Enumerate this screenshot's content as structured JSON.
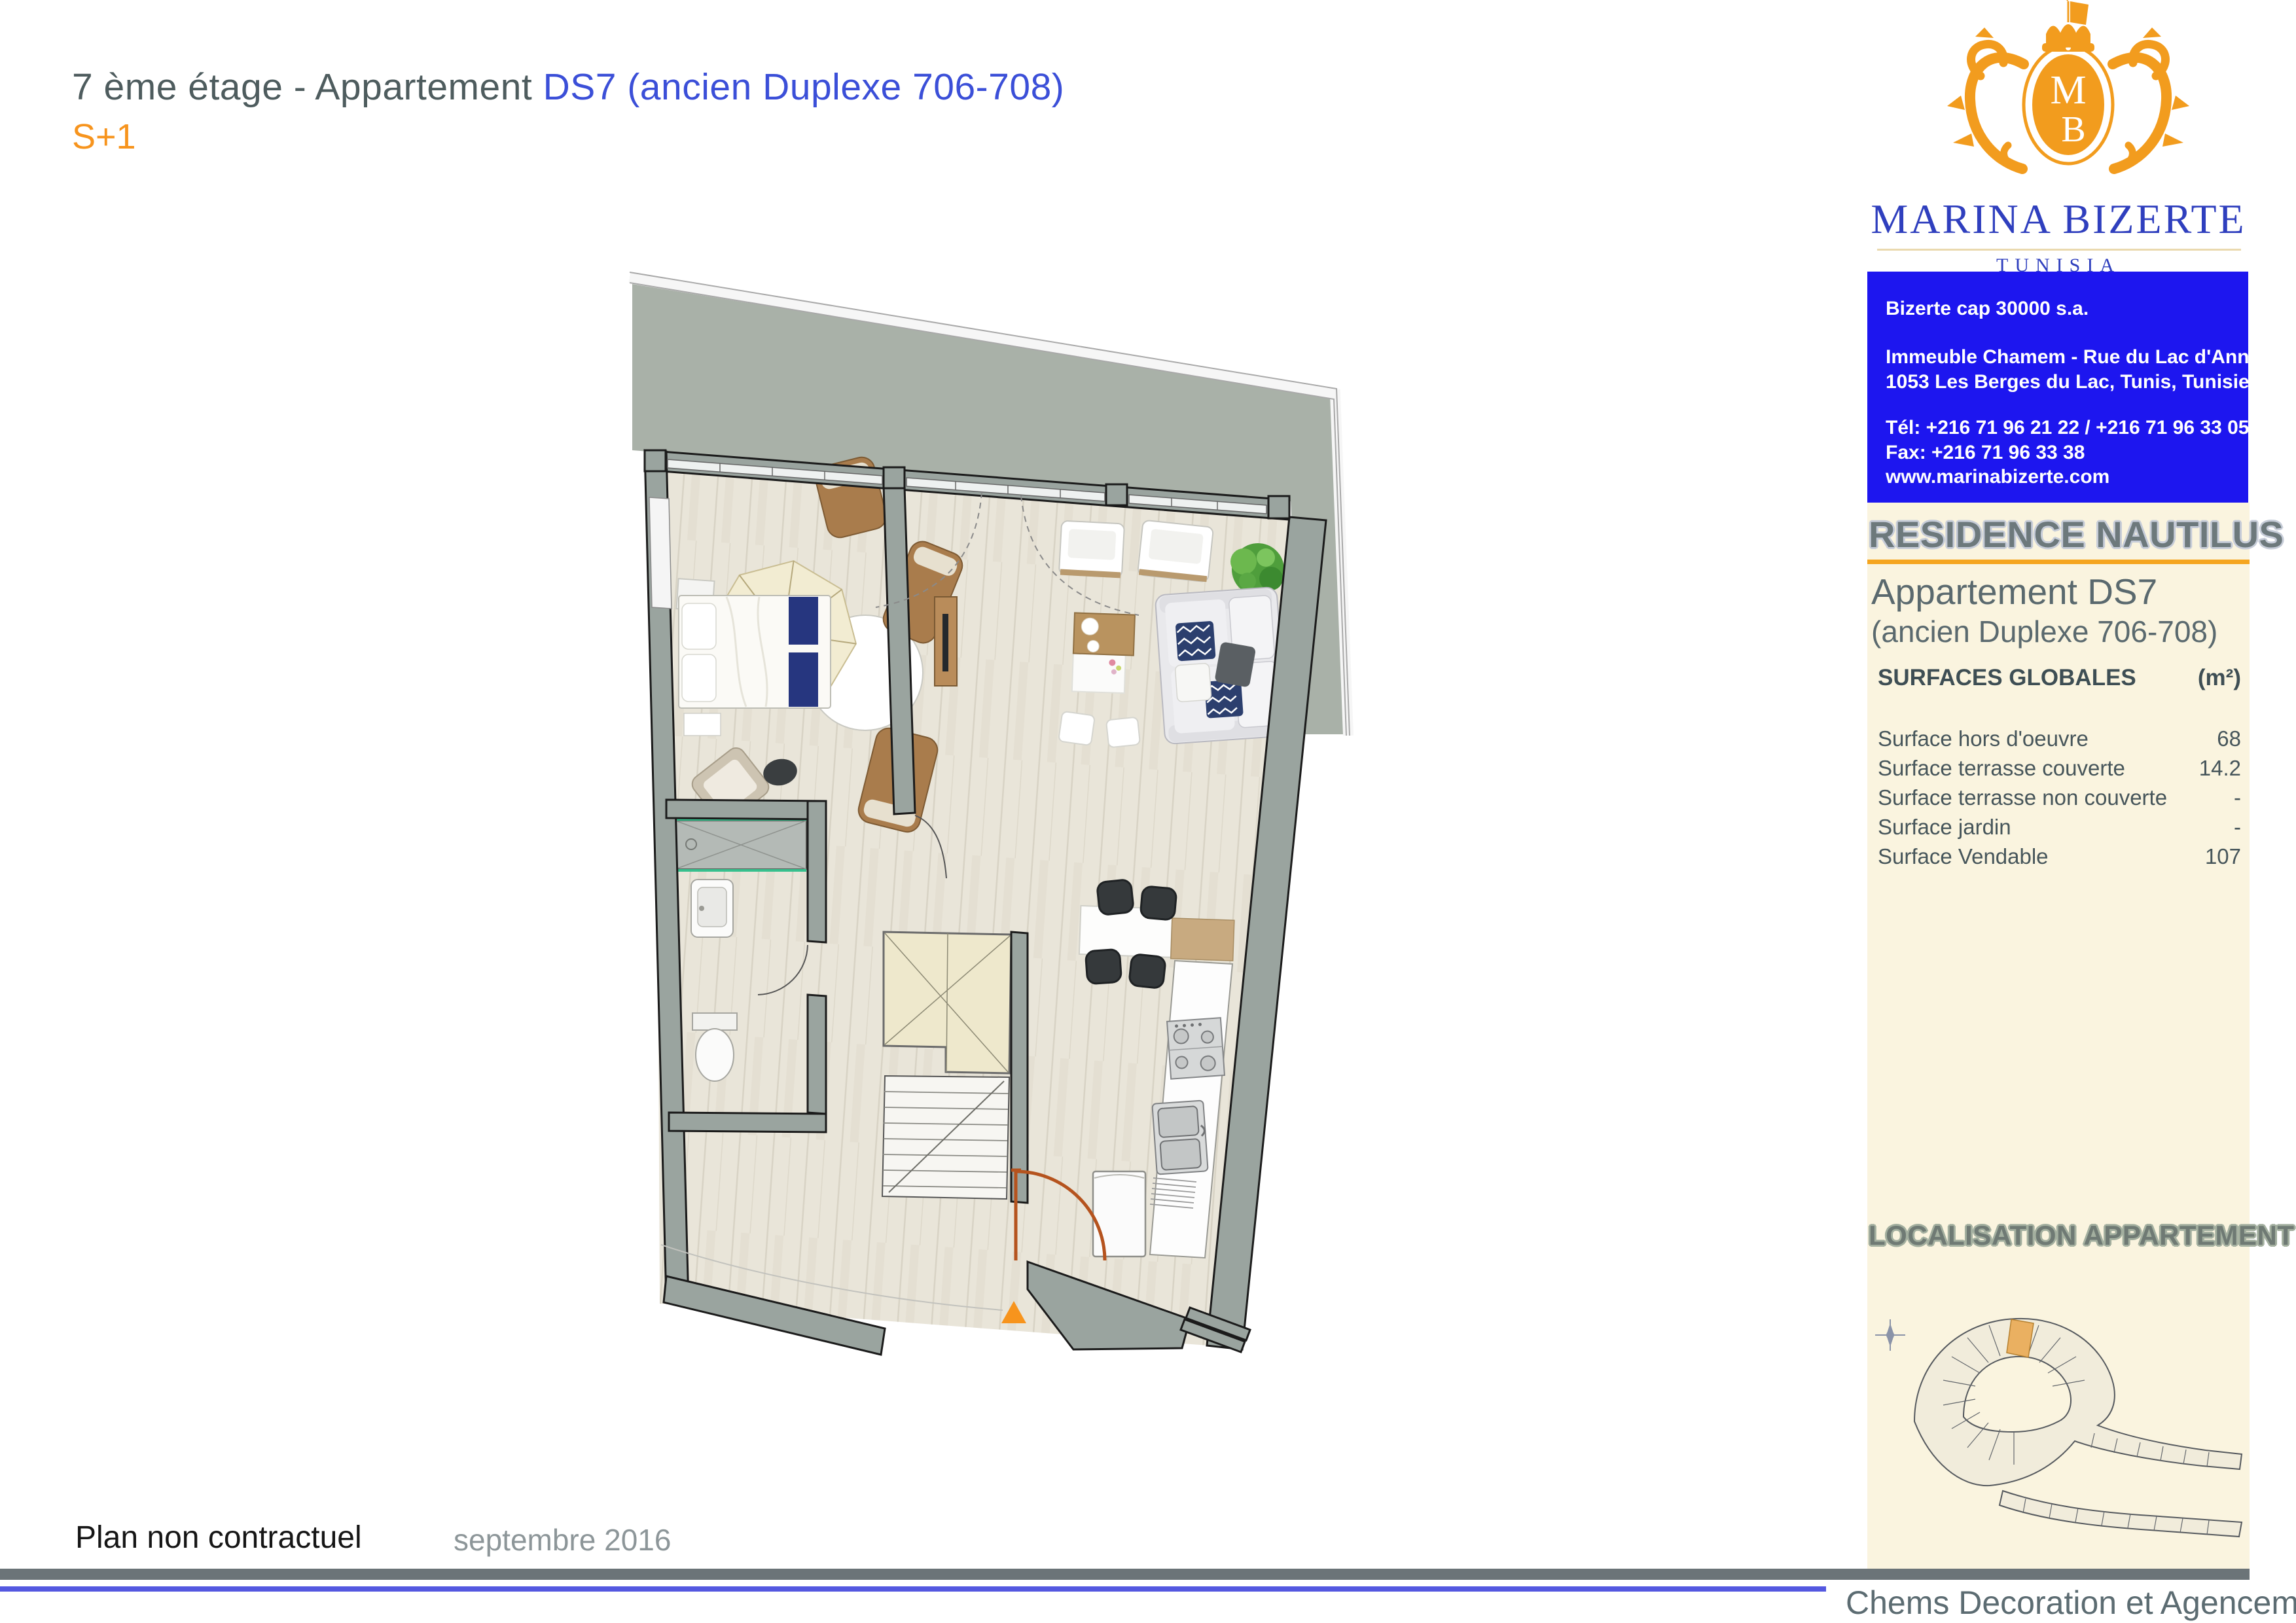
{
  "header": {
    "title_prefix": "7 ème étage - Appartement ",
    "title_highlight": "DS7 (ancien Duplexe 706-708)",
    "subtitle": "S+1"
  },
  "logo": {
    "brand": "MARINA BIZERTE",
    "country": "TUNISIA",
    "monogram_top": "M",
    "monogram_bottom": "B"
  },
  "contact_box": {
    "company": "Bizerte cap 30000 s.a.",
    "address_line1": "Immeuble Chamem - Rue du Lac d'Annecy,",
    "address_line2": "1053 Les Berges du Lac, Tunis, Tunisie.",
    "phone": "Tél: +216 71 96 21 22 / +216 71 96 33 05",
    "fax": "Fax: +216 71 96 33 38",
    "website": "www.marinabizerte.com"
  },
  "info_panel": {
    "residence": "RESIDENCE NAUTILUS",
    "apartment_title": "Appartement DS7",
    "apartment_subtitle": "(ancien Duplexe 706-708)",
    "surfaces_header": "SURFACES GLOBALES",
    "surfaces_unit": "(m²)",
    "surfaces": [
      {
        "label": "Surface hors d'oeuvre",
        "value": "68"
      },
      {
        "label": "Surface terrasse couverte",
        "value": "14.2"
      },
      {
        "label": "Surface terrasse non couverte",
        "value": "-"
      },
      {
        "label": "Surface jardin",
        "value": "-"
      },
      {
        "label": "Surface Vendable",
        "value": "107"
      }
    ],
    "localisation_title": "LOCALISATION APPARTEMENT"
  },
  "footer": {
    "disclaimer": "Plan non contractuel",
    "date": "septembre 2016",
    "credit": "Chems Decoration et Agencement"
  },
  "colors": {
    "accent_orange": "#F7941D",
    "underline_orange": "#F5A51F",
    "brand_blue": "#2F3FBE",
    "box_blue": "#1D16EF",
    "title_highlight_blue": "#3B4FD8",
    "panel_cream": "#FAF4DF",
    "wall_gray": "#9AA49F",
    "terrace_gray": "#A9B1A8",
    "bar_gray": "#6B7478",
    "footer_line_blue": "#5458E0"
  }
}
